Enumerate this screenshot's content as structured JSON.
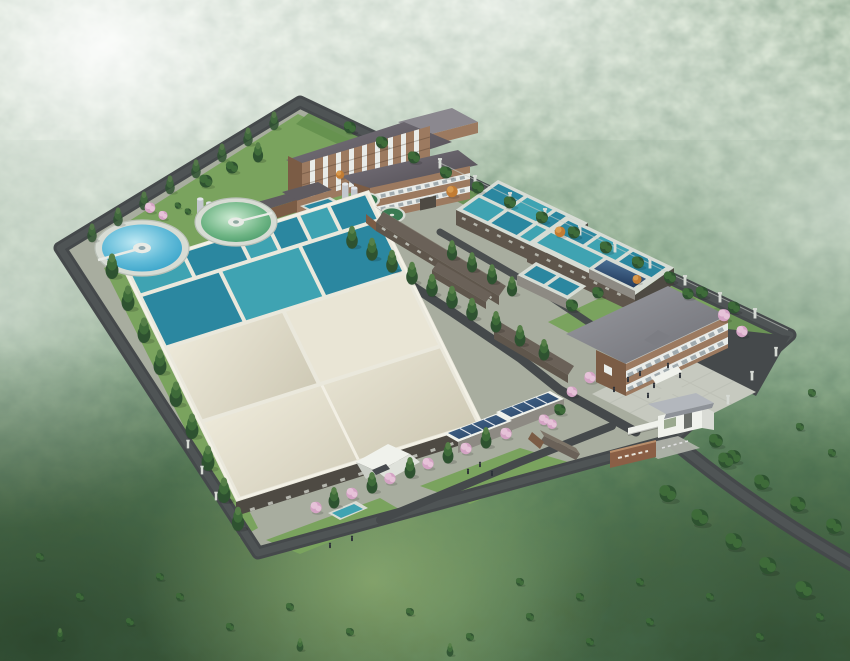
{
  "scene": {
    "title": "Aerial rendering of a water treatment plant in forested hills",
    "view": "bird's-eye perspective rendering",
    "site_elements": [
      "perimeter-road",
      "access-road",
      "internal-roads",
      "sedimentation-basin-complex",
      "open-aeration-basins",
      "covered-basins",
      "circular-clarifier-blue",
      "circular-clarifier-green",
      "small-round-tanks",
      "storage-silos",
      "filter-basin-upper",
      "filter-basin-lower",
      "contact-basin-1",
      "contact-basin-2",
      "pump-house",
      "utility-building",
      "workshop",
      "admin-building",
      "admin-wing",
      "office-building",
      "plaza",
      "parking-apron",
      "entrance-gatehouse",
      "entrance-sign",
      "canopy-pavilion",
      "skylight-basins",
      "garden-pond"
    ],
    "environment": [
      "forest-hills",
      "mist-haze",
      "lawns",
      "conifer-rows",
      "blossom-trees",
      "autumn-trees",
      "fence-posts",
      "people"
    ]
  },
  "counts": {
    "circular_clarifiers": 2,
    "small_round_tanks": 2,
    "covered_basin_panels": 3,
    "admin_building_floors": 4,
    "office_building_floors": 2
  },
  "colors": {
    "concrete": "#a8ad9f",
    "lawn": "#7aa35e",
    "lawn_dark": "#64904e",
    "road": "#45494b",
    "road_light": "#585d5f",
    "paving": "#c6c9bf",
    "deck": "#eae8dc",
    "rim": "#d7dcd4",
    "basin_roof": "#dcd6c2",
    "basin_roof_light": "#e9e5d5",
    "water_teal": "#3fa3b2",
    "water_teal_deep": "#2b87a0",
    "water_blue": "#2f9ec6",
    "water_blue_light": "#bfe9f4",
    "water_green": "#3f9362",
    "water_green_light": "#cdebd3",
    "tank_green": "#3a7a52",
    "brick": "#9c7a60",
    "brick_dark": "#7b5c45",
    "dark_wall": "#4e4a43",
    "brown_wall": "#5f564c",
    "wall_gray": "#8d8a83",
    "roof_gray": "#8b888f",
    "roof_gray_dark": "#5f5b60",
    "roof_brown": "#6a6158",
    "roof_brown_light": "#7d7468",
    "white_wall": "#f0f2ec",
    "window_white": "#e9ece9",
    "glass_blue": "#4a6f94",
    "glass_blue_dark": "#243c5e",
    "tree_dark": "#2e5230",
    "tree_mid": "#3e6b39",
    "tree_light": "#557f47",
    "blossom": "#d4a3c4",
    "blossom_light": "#e6c2d8",
    "autumn": "#c27c33",
    "autumn_light": "#d89a4e",
    "fence_post": "#d6dad4",
    "figure": "#2c3138",
    "sign_brick": "#8a5f46",
    "gate_roof": "#b3b7bd",
    "mist": "#f4f7f2",
    "forest_light": "#b6cab0",
    "forest_mid": "#7ea382",
    "forest_dark": "#3c5c38",
    "forest_deep": "#22381f"
  }
}
